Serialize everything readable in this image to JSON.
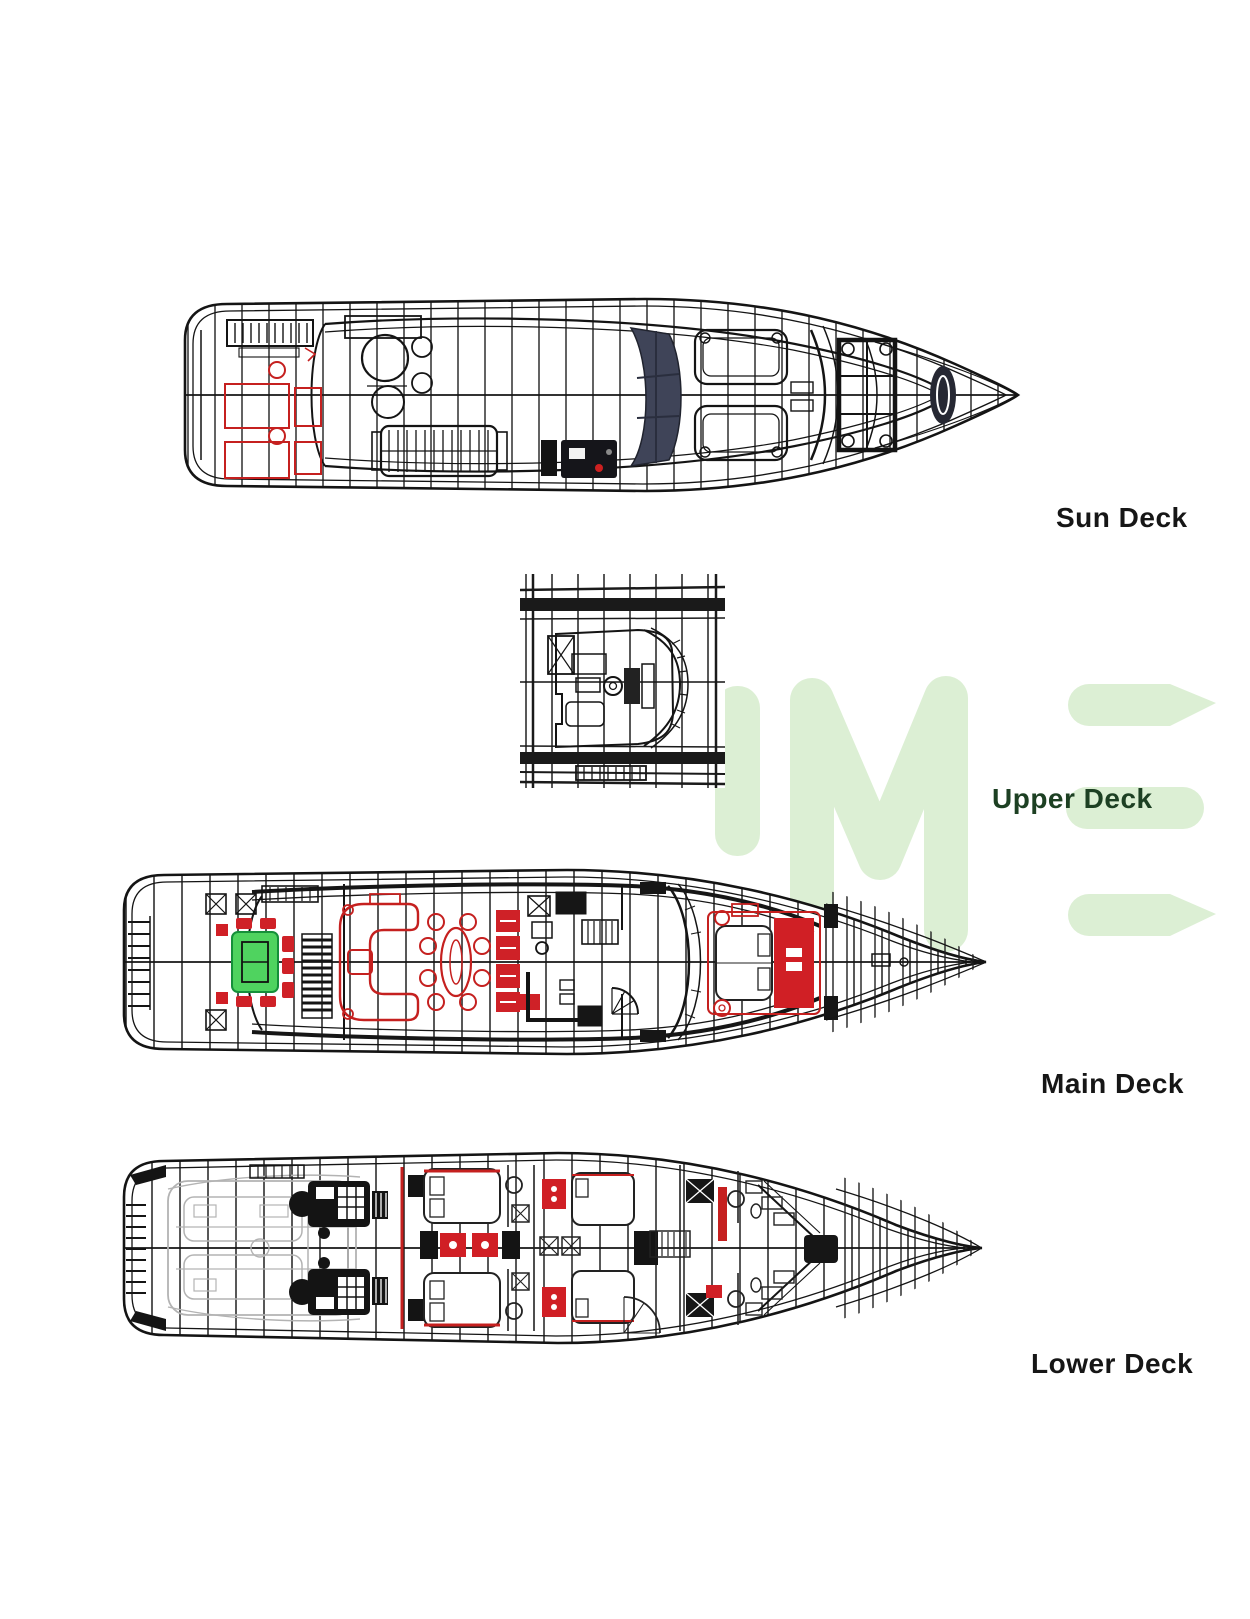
{
  "page": {
    "title": "Yacht deck plans",
    "background": "#ffffff"
  },
  "decks": [
    {
      "id": "sun-deck",
      "label": "Sun Deck"
    },
    {
      "id": "upper-deck",
      "label": "Upper Deck"
    },
    {
      "id": "main-deck",
      "label": "Main Deck"
    },
    {
      "id": "lower-deck",
      "label": "Lower Deck"
    }
  ],
  "watermark": {
    "letters": "IME",
    "color": "#dcefd4"
  },
  "colors": {
    "line": "#1a1a1a",
    "accent_red": "#c5201f",
    "accent_red_fill": "#d01f25",
    "accent_green_table": "#4fd35f",
    "sunroof_panel": "#3f4458",
    "garage_gray": "#b3b3b3",
    "label_text": "#161616",
    "upper_label_text": "#1d4023",
    "watermark_green": "#dcefd4"
  }
}
